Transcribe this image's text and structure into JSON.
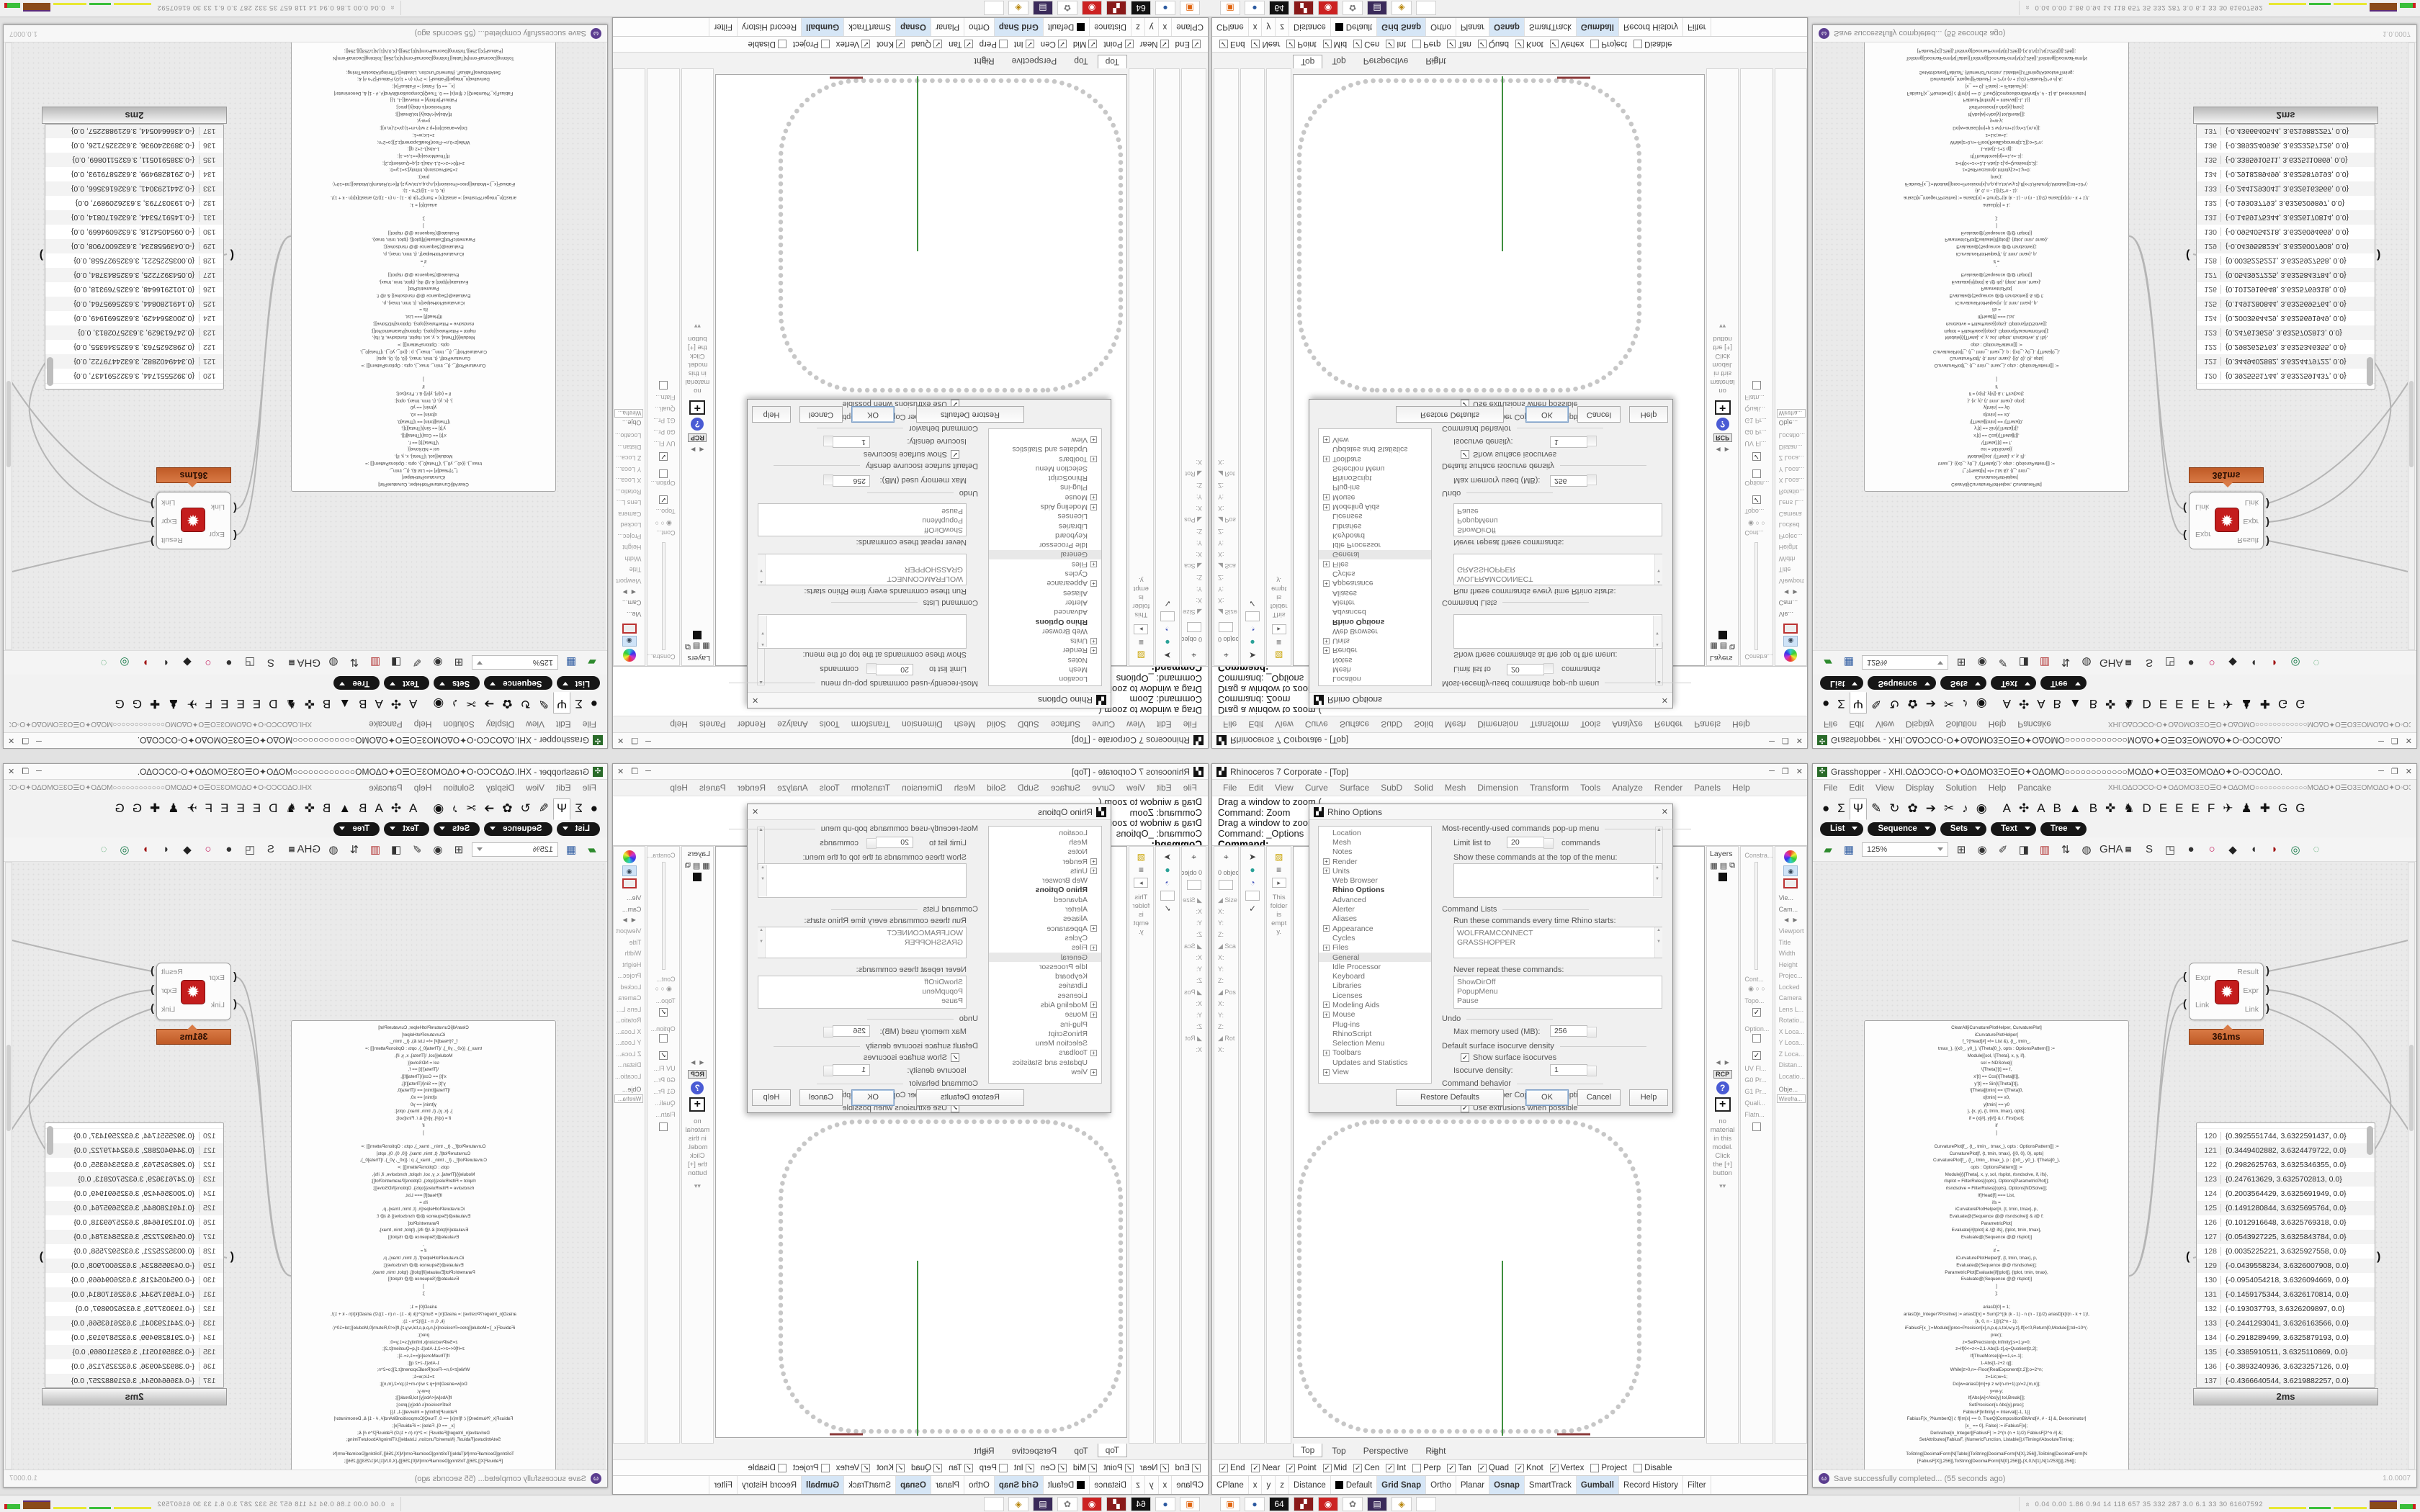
{
  "window_controls": {
    "minimize": "─",
    "maximize": "❐",
    "close": "✕"
  },
  "rhino": {
    "title": "Rhinoceros 7 Corporate - [Top]",
    "icon_glyph": "▞",
    "menu": [
      "File",
      "Edit",
      "View",
      "Curve",
      "Surface",
      "SubD",
      "Solid",
      "Mesh",
      "Dimension",
      "Transform",
      "Tools",
      "Analyze",
      "Render",
      "Panels",
      "Help"
    ],
    "command_lines": [
      "Drag a window to zoom (",
      "Command: Zoom",
      "Drag a window to zoom (",
      "Command: _Options"
    ],
    "command_prompt": "Command:",
    "left_dock": {
      "objects_label": "0 objects",
      "gizmo_icons": [
        "⌖",
        "✱"
      ],
      "col2_icons": [
        "➤",
        "●",
        "◔",
        "✓"
      ],
      "transform_labels": [
        "◢ Size",
        "X:",
        "Y:",
        "Z:",
        "◢ Sca",
        "X:",
        "Y:",
        "Z:",
        "◢ Pos",
        "X:",
        "Y:",
        "Z:",
        "◢ Rot",
        "X:"
      ],
      "folder_note": "This folder is empty.",
      "folder_icons": [
        "▨",
        "≡",
        "▸"
      ]
    },
    "right_dock": {
      "layers_title": "Layers",
      "layers_icons": [
        "▦",
        "▤",
        "⧉"
      ],
      "rcp_label": "RCP",
      "material_note": "no material in this model. Click the [+] button",
      "chevrons": "▾▾",
      "mid_labels": [
        "Constra...",
        "Cont...",
        "Topo...",
        "Option...",
        "UV Fl...",
        "G0 Pr...",
        "G1 Pr...",
        "Quali...",
        "Flatn..."
      ],
      "radio_glyphs": "◉ ○ ○",
      "view_label": "Vie...",
      "cam_label": "Cam...",
      "viewport_props": [
        "Viewport",
        "Title",
        "Width",
        "Height",
        "Projec...",
        "Locked",
        "Camera",
        "Lens L...",
        "Rotatio...",
        "X Loca...",
        "Y Loca...",
        "Z Loca...",
        "Distan...",
        "Locatio..."
      ],
      "object_label": "Obje...",
      "display_mode": "Wirefra..."
    },
    "viewport_tabs": [
      {
        "label": "Top",
        "active": true
      },
      {
        "label": "Top"
      },
      {
        "label": "Perspective"
      },
      {
        "label": "Right"
      }
    ],
    "viewport_tab_plus": "✛",
    "osnap_items": [
      {
        "label": "End",
        "checked": true
      },
      {
        "label": "Near",
        "checked": true
      },
      {
        "label": "Point",
        "checked": true
      },
      {
        "label": "Mid",
        "checked": true
      },
      {
        "label": "Cen",
        "checked": true
      },
      {
        "label": "Int",
        "checked": true
      },
      {
        "label": "Perp"
      },
      {
        "label": "Tan",
        "checked": true
      },
      {
        "label": "Quad",
        "checked": true
      },
      {
        "label": "Knot",
        "checked": true
      },
      {
        "label": "Vertex",
        "checked": true
      },
      {
        "label": "Project"
      },
      {
        "label": "Disable"
      }
    ],
    "status_cells": [
      {
        "label": "CPlane"
      },
      {
        "label": "x"
      },
      {
        "label": "y"
      },
      {
        "label": "z"
      },
      {
        "label": "Distance"
      },
      {
        "label": "Default",
        "swatch": true
      },
      {
        "label": "Grid Snap",
        "on": true
      },
      {
        "label": "Ortho"
      },
      {
        "label": "Planar"
      },
      {
        "label": "Osnap",
        "on": true
      },
      {
        "label": "SmartTrack"
      },
      {
        "label": "Gumball",
        "on": true
      },
      {
        "label": "Record History"
      },
      {
        "label": "Filter"
      }
    ],
    "options_dialog": {
      "title": "Rhino Options",
      "close_glyph": "✕",
      "tree": [
        {
          "label": "Location"
        },
        {
          "label": "Mesh"
        },
        {
          "label": "Notes"
        },
        {
          "label": "Render",
          "exp": true
        },
        {
          "label": "Units",
          "exp": true
        },
        {
          "label": "Web Browser"
        },
        {
          "label": "Rhino Options",
          "head": true
        },
        {
          "label": "Advanced"
        },
        {
          "label": "Alerter"
        },
        {
          "label": "Aliases"
        },
        {
          "label": "Appearance",
          "exp": true
        },
        {
          "label": "Cycles"
        },
        {
          "label": "Files",
          "exp": true
        },
        {
          "label": "General",
          "sel": true
        },
        {
          "label": "Idle Processor"
        },
        {
          "label": "Keyboard"
        },
        {
          "label": "Libraries"
        },
        {
          "label": "Licenses"
        },
        {
          "label": "Modeling Aids",
          "exp": true
        },
        {
          "label": "Mouse",
          "exp": true
        },
        {
          "label": "Plug-ins"
        },
        {
          "label": "RhinoScript"
        },
        {
          "label": "Selection Menu"
        },
        {
          "label": "Toolbars",
          "exp": true
        },
        {
          "label": "Updates and Statistics"
        },
        {
          "label": "View",
          "exp": true
        }
      ],
      "mru_title": "Most-recently-used commands pop-up menu",
      "limit_label": "Limit list to",
      "limit_value": "20",
      "limit_suffix": "commands",
      "show_top_label": "Show these commands at the top of the menu:",
      "cmd_lists_title": "Command Lists",
      "run_label": "Run these commands every time Rhino starts:",
      "run_items": [
        "WOLFRAMCONNECT",
        "GRASSHOPPER"
      ],
      "never_label": "Never repeat these commands:",
      "never_items": [
        "ShowDirOff",
        "PopupMenu",
        "Pause"
      ],
      "undo_title": "Undo",
      "max_mem_label": "Max memory used (MB):",
      "max_mem_value": "256",
      "isocurve_title": "Default surface isocurve density",
      "show_iso_label": "Show surface isocurves",
      "show_iso_checked": true,
      "iso_density_label": "Isocurve density:",
      "iso_density_value": "1",
      "behavior_title": "Command behavior",
      "remember_label": "Remember Copy=Yes/No options",
      "remember_checked": true,
      "extrusions_label": "Use extrusions when possible",
      "extrusions_checked": true,
      "buttons": [
        "Restore Defaults",
        "OK",
        "Cancel",
        "Help"
      ]
    }
  },
  "grasshopper": {
    "title": "Grasshopper - ΧΗΙ.ΟΔΟϽCΟ◦Ο✦ΟΔΟΜΟ3ΞΟ☰Ο✦ΟΔΟΜΟ○○○○○○○○○○○○ΜΟΔΟ✦Ο☰Ο3ΞΟΜΟΔΟ✦Ο◦ΟϽCΟΔΟ.",
    "doc_glyphs": "ΧΗΙ.ΟΔΟϽCΟ◦Ο✦ΟΔΟΜΟ3ΞΟ☰Ο✦ΟΔΟΜΟ○○○○○○○○○○○○ΜΟΔΟ✦Ο☰Ο3ΞΟΜΟΔΟ✦Ο◦ΟϽCΟΔΟ.",
    "icon_glyph": "✣",
    "menu": [
      "File",
      "Edit",
      "View",
      "Display",
      "Solution",
      "Help",
      "Pancake"
    ],
    "tab_glyphs": [
      {
        "g": "●"
      },
      {
        "g": "Σ"
      },
      {
        "g": "Ψ",
        "active": true
      },
      {
        "g": "✎"
      },
      {
        "g": "↻"
      },
      {
        "g": "✿"
      },
      {
        "g": "➔"
      },
      {
        "g": "✂"
      },
      {
        "g": "♪"
      },
      {
        "g": "◉"
      },
      {
        "g": " "
      },
      {
        "g": "A"
      },
      {
        "g": "✣"
      },
      {
        "g": "A"
      },
      {
        "g": "B"
      },
      {
        "g": "▲"
      },
      {
        "g": "B"
      },
      {
        "g": "✜"
      },
      {
        "g": "♞"
      },
      {
        "g": "D"
      },
      {
        "g": "E"
      },
      {
        "g": "E"
      },
      {
        "g": "E"
      },
      {
        "g": "F"
      },
      {
        "g": "✈"
      },
      {
        "g": "♟"
      },
      {
        "g": "✚"
      },
      {
        "g": "G"
      },
      {
        "g": "G"
      }
    ],
    "category_tabs": [
      "List",
      "Sequence",
      "Sets",
      "Text",
      "Tree"
    ],
    "zoom_level": "125%",
    "toolbar_icons": [
      "▰",
      "▦",
      "⊞",
      "◉",
      "✐",
      "◨",
      "▥",
      "⇅",
      "◍",
      "GHA",
      "▤",
      "S",
      "◳",
      "●",
      "○",
      "◆",
      "◖",
      "◗",
      "◎",
      "◌"
    ],
    "code_panel": {
      "time": "0ms",
      "lines": [
        "ClearAll[iCurvaturePlotHelper, CurvaturePlot]",
        "iCurvaturePlotHelper[",
        "f_?(Head[#] =!= List &), {t_, tmin_,",
        "tmax_}, {{x0_, y0_}, \\[Theta]0_}, opts : OptionsPattern[]] :=",
        "Module[{sol, \\[Theta], x, y, if},",
        "sol = NDSolve[{",
        "\\[Theta]'[t] == f,",
        "x'[t] == Cos[\\[Theta][t]],",
        "y'[t] == Sin[\\[Theta][t]],",
        "\\[Theta][tmin] == \\[Theta]0,",
        "x[tmin] == x0,",
        "y[tmin] == y0",
        "}, {x, y}, {t, tmin, tmax}, opts];",
        "if = {x[#], y[#]} & /. First[sol];",
        "if",
        "]",
        "",
        "CurvaturePlot[f_, {t_, tmin_, tmax_}, opts : OptionsPattern[]] :=",
        "CurvaturePlot[f, {t, tmin, tmax}, {{0, 0}, 0}, opts]",
        "CurvaturePlot[f_, {t_, tmin_, tmax_}, p : {{x0_, y0_}, \\[Theta]0_},",
        "opts : OptionsPattern[]] :=",
        "Module[{\\[Theta], x, y, sol, rlsplot, rlsndsolve, if, ifs},",
        "rlsplot = FilterRules[{opts}, Options[ParametricPlot]];",
        "rlsndsolve = FilterRules[{opts}, Options[NDSolve]];",
        "If[Head[f] === List,",
        "ifs =",
        "iCurvaturePlotHelper[#, {t, tmin, tmax}, p,",
        "Evaluate@(Sequence @@ rlsndsolve)] & /@ f;",
        "ParametricPlot[",
        "Evaluate[#[tplot] & /@ ifs], {tplot, tmin, tmax},",
        "Evaluate@(Sequence @@ rlsplot)]",
        ",",
        "if =",
        "iCurvaturePlotHelper[f, {t, tmin, tmax}, p,",
        "Evaluate@(Sequence @@ rlsndsolve)];",
        "ParametricPlot[Evaluate[if[tplot]], {tplot, tmin, tmax},",
        "Evaluate@(Sequence @@ rlsplot)]",
        "]",
        "];",
        "",
        "ariasD[0] = 1;",
        "ariasD[n_Integer?Positive] := ariasD[n] = Sum[2^((k (k - 1) - n (n - 1))/2) ariasD[k]/(n - k + 1)!,",
        "{k, 0, n - 1}]/(2^n - 1);",
        "iFabiusF[x_]:=Module[{prec=Precision[x],n,p,q,s,tol,w,y,z},If[x<0,Return[0,Module]];tol=10^(-",
        "prec);",
        "z=SetPrecision[x,Infinity];s=1;y=0;",
        "z=If[0<=z<=2,1-Abs[1-z],q=Quotient[z,2];",
        "If[ThueMorse[q]==1,s=-1];",
        "1-Abs[1-z+2 q]];",
        "While[z>0,n=-Floor[RealExponent[z,2]];o=2^n;",
        "z=1/c;w=1;",
        "Do[w=ariasD[m]+p z w/(n-m+1);p/=2,{m,n}];",
        "y=w-y;",
        "If[Abs[w]<Abs[y] tol,Break[]];",
        "SetPrecision[s Abs[y],prec];",
        "FabiusF[Infinity] = Interval[{-1, 1}]",
        "FabiusF[x_?NumberQ] /; f[Im[x] == 0, TrueQ[CompositionBitAnd[#, # - 1] &, Denominator]",
        "[x_ == 0], False] := iFabiusF[x];",
        "Derivative[n_Integer][FabiusF] := 2^(n (n + 1)/2) FabiusF[2^n #] &;",
        "SetAttributes[FabiusF, {NumericFunction, Listable}];//Timing//AbsoluteTiming;",
        "",
        "ToString[DecimalForm[N[Table[{ToString[DecimalForm[N[X],256]],ToString[DecimalForm[N",
        "[FabiusF[X]],256]],ToString[DecimalForm[N[0],256]]},{X,0,N[1],N[1/253]}]],256]];",
        "",
        "Π = CurvaturePlot[",
        "Evaluate[",
        "SetPrecision[SetAccuracy[Abs[FabiusF[X/Pi*((((4))))/2]], Infinity],",
        "Infinity], {X, 0, 4 \\[Pi]}, WorkingPrecision -> ((((10)))),",
        "Accuracy -> Infinity, MaxRecursion -> 0, PlotPoints -> 1 + 2^((((8))))],",
        "Axes -> {True, True}];",
        "Show[Π, Frame -> True, FrameTicks -> {{-1, 0, 1}, {-1, 0, 1}},",
        "PlotRange -> Full, AspectRatio -> 1];",
        "ΦΠΦ = Flatten[Cases[Π, Line[X__] -> X, Infinity], 1];",
        "Export[\"ΦΠΦ\", ΦΠΦ, \"CSV\"];",
        "ΦΠΦ"
      ]
    },
    "expression": {
      "icon_glyph": "✹",
      "port_open": "(",
      "port_close": ")",
      "inputs": [
        {
          "label": "Expr"
        },
        {
          "label": "Link"
        }
      ],
      "outputs": [
        {
          "label": "Result"
        },
        {
          "label": "Expr"
        },
        {
          "label": "Link"
        }
      ],
      "time": "361ms"
    },
    "list_panel": {
      "time": "2ms",
      "rows": [
        {
          "n": "120",
          "v": "{0.3925551744, 3.6322591437, 0.0}"
        },
        {
          "n": "121",
          "v": "{0.3449402882, 3.6324479722, 0.0}"
        },
        {
          "n": "122",
          "v": "{0.2982625763, 3.6325346355, 0.0}"
        },
        {
          "n": "123",
          "v": "{0.247613629, 3.6325702813, 0.0}"
        },
        {
          "n": "124",
          "v": "{0.2003564429, 3.6325691949, 0.0}"
        },
        {
          "n": "125",
          "v": "{0.1491280844, 3.6325695764, 0.0}"
        },
        {
          "n": "126",
          "v": "{0.1012916648, 3.6325769318, 0.0}"
        },
        {
          "n": "127",
          "v": "{0.0543927225, 3.6325843784, 0.0}"
        },
        {
          "n": "128",
          "v": "{0.0035225221, 3.6325927558, 0.0}"
        },
        {
          "n": "129",
          "v": "{-0.0439558234, 3.6326007908, 0.0}"
        },
        {
          "n": "130",
          "v": "{-0.0954054218, 3.6326094669, 0.0}"
        },
        {
          "n": "131",
          "v": "{-0.1459175344, 3.6326170814, 0.0}"
        },
        {
          "n": "132",
          "v": "{-0.193037793, 3.6326209897, 0.0}"
        },
        {
          "n": "133",
          "v": "{-0.2441293041, 3.6326163566, 0.0}"
        },
        {
          "n": "134",
          "v": "{-0.2918289499, 3.6325879193, 0.0}"
        },
        {
          "n": "135",
          "v": "{-0.3385910511, 3.6325110869, 0.0}"
        },
        {
          "n": "136",
          "v": "{-0.3893240936, 3.6323257126, 0.0}"
        },
        {
          "n": "137",
          "v": "{-0.4366640544, 3.6219882257, 0.0}"
        }
      ]
    },
    "statusbar": {
      "text": "Save successfully completed... (55 seconds ago)",
      "version": "1.0.0007"
    }
  },
  "taskbar": {
    "icons": [
      "▣",
      "●",
      "64",
      "▞",
      "◉",
      "✿",
      "▤",
      "◈",
      "✦"
    ],
    "monitor_prefix": "»",
    "monitor_text": "0.04 0.00 1.86 0.94  14  118  657  35  332  287  3.0  6.1  33  30  61607592"
  }
}
